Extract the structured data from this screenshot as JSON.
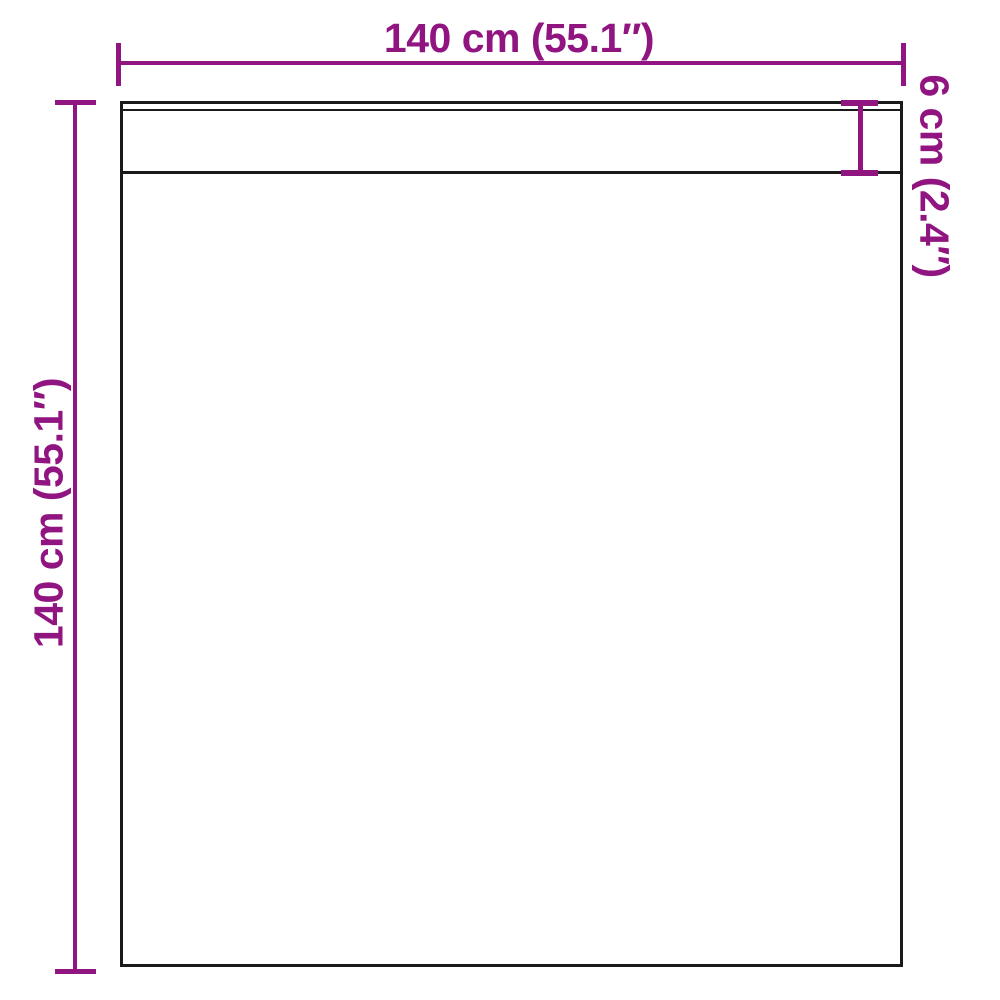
{
  "diagram": {
    "labels": {
      "width": "140 cm (55.1″)",
      "height": "140 cm (55.1″)",
      "hem": "6 cm (2.4″)"
    },
    "colors": {
      "dimension_accent": "#911581",
      "outline": "#1a1a1a",
      "background": "#ffffff"
    }
  }
}
